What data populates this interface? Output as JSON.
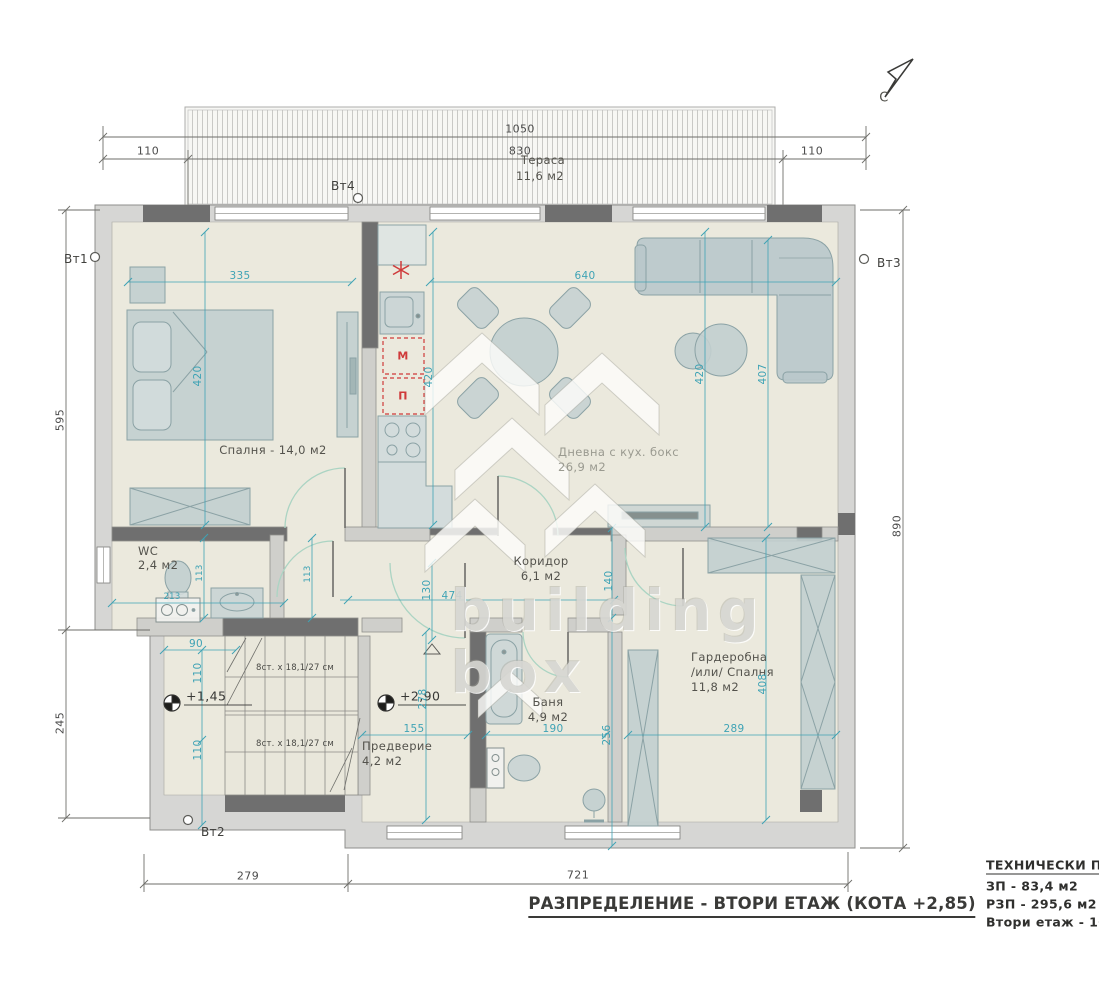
{
  "compass": {
    "north_label": "С"
  },
  "dims": {
    "d1050": "1050",
    "d830": "830",
    "d110_left": "110",
    "d110_right": "110",
    "d595": "595",
    "d245": "245",
    "d890": "890",
    "d279": "279",
    "d721": "721",
    "d335": "335",
    "d420_bedroom": "420",
    "d420_kitchen": "420",
    "d640": "640",
    "d420_living": "420",
    "d407": "407",
    "d113_a": "113",
    "d113_b": "113",
    "d213": "213",
    "d90": "90",
    "d110_a": "110",
    "d110_b": "110",
    "d130": "130",
    "d474": "474",
    "d140": "140",
    "d278": "278",
    "d155": "155",
    "d190": "190",
    "d256": "256",
    "d289": "289",
    "d408": "408"
  },
  "markers": {
    "vt1": "Вт1",
    "vt2": "Вт2",
    "vt3": "Вт3",
    "vt4": "Вт4"
  },
  "terrace": {
    "name": "Тераса",
    "area": "11,6 м2"
  },
  "rooms": {
    "bedroom": {
      "label": "Спалня - 14,0 м2"
    },
    "living": {
      "name": "Дневна с кух. бокс",
      "area": "26,9 м2"
    },
    "wc": {
      "name": "WC",
      "area": "2,4 м2"
    },
    "corridor": {
      "name": "Коридор",
      "area": "6,1 м2"
    },
    "entry": {
      "name": "Предверие",
      "area": "4,2 м2"
    },
    "bath": {
      "name": "Баня",
      "area": "4,9 м2"
    },
    "wardrobe": {
      "name": "Гардеробна",
      "alt": "/или/ Спалня",
      "area": "11,8 м2"
    }
  },
  "kitchen": {
    "m": "М",
    "p": "П"
  },
  "stairs": {
    "upper": "8ст. x 18,1/27 см",
    "lower": "8ст. x 18,1/27 см"
  },
  "elevations": {
    "level1": "+1,45",
    "level2": "+2,90"
  },
  "title": "РАЗПРЕДЕЛЕНИЕ - ВТОРИ ЕТАЖ (КОТА +2,85)",
  "tech": {
    "heading": "ТЕХНИЧЕСКИ ПОК",
    "zp": "ЗП  - 83,4 м2",
    "rzp": "РЗП - 295,6 м2",
    "floor_line": "Втори етаж - 106"
  },
  "watermark": {
    "line1": "building",
    "line2": "box"
  },
  "colors": {
    "dim_teal": "#3fa3b5",
    "wall_dark": "#6f6f6f",
    "wall_light": "#d6d6d4",
    "floor": "#ebe9dd",
    "accent_red": "#cf3a3a"
  }
}
